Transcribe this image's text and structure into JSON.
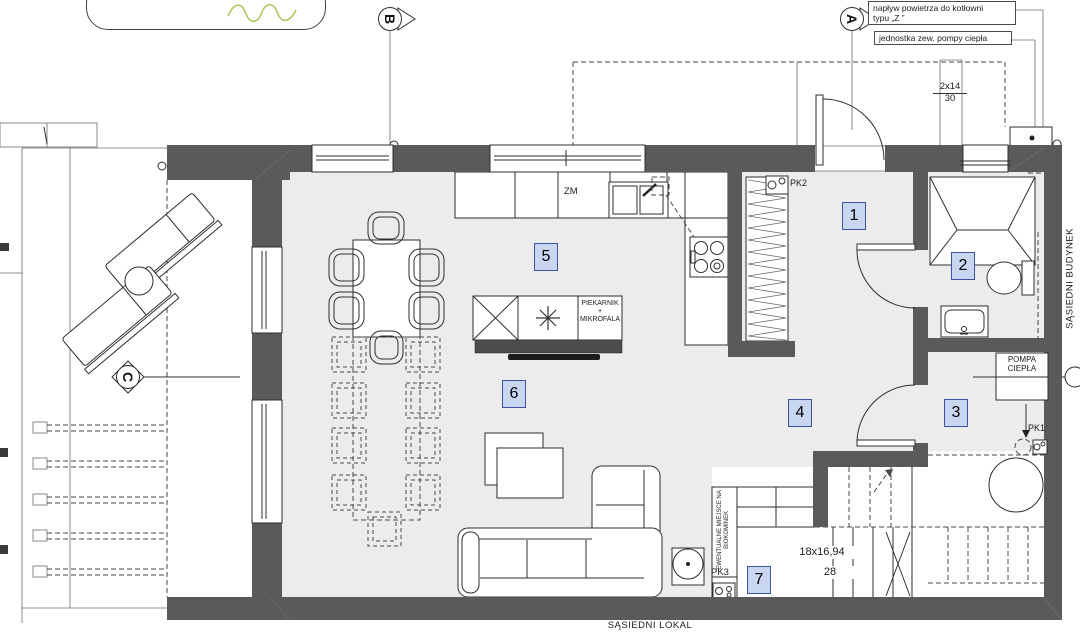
{
  "annotations": {
    "air_inflow_line1": "napływ powietrza do kotłowni",
    "air_inflow_line2": "typu „Z ”",
    "heat_pump_unit_label": "jednostka zew. pompy ciepła",
    "exterior_steps_count": "2x14",
    "exterior_steps_tread": "30",
    "stairs_count": "18x16,94",
    "stairs_tread": "28",
    "neighbor_building": "SĄSIEDNI BUDYNEK",
    "neighbor_unit": "SĄSIEDNI LOKAL",
    "biofireplace_line1": "EWENTUALNE MIEJSCE NA",
    "biofireplace_line2": "BIOKOMINEK"
  },
  "equipment": {
    "dishwasher": "ZM",
    "oven_line1": "PIEKARNIK",
    "oven_line2": "+",
    "oven_line3": "MIKROFALA",
    "heat_pump_line1": "POMPA",
    "heat_pump_line2": "CIEPŁA",
    "pk1": "PK1",
    "pk2": "PK2",
    "pk3": "PK3"
  },
  "rooms": [
    "1",
    "2",
    "3",
    "4",
    "5",
    "6",
    "7"
  ],
  "markers": {
    "a": "A",
    "b": "B",
    "c": "C"
  },
  "colors": {
    "wall": "#5a5a5a",
    "floor": "#ececec",
    "room_badge_fill": "#c9d6f0",
    "room_badge_border": "#3f51a3",
    "stamp_green": "#a9c45c"
  }
}
